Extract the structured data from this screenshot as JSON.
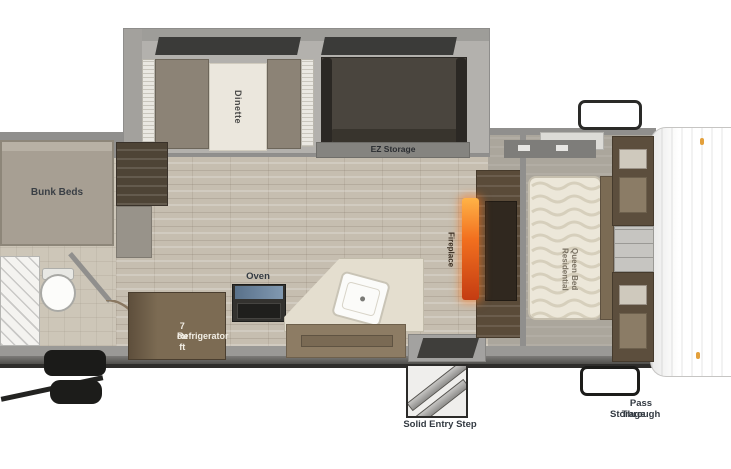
{
  "diagram_type": "rv-travel-trailer-floorplan",
  "labels": {
    "bunk_beds": "Bunk Beds",
    "dinette": "Dinette",
    "ez_storage": "EZ Storage",
    "fireplace": "Fireplace",
    "queen_bed_line1": "Residential",
    "queen_bed_line2": "Queen Bed",
    "oven": "Oven",
    "fridge_line1": "7 cu ft",
    "fridge_line2": "Refrigerator",
    "entry_step": "Solid Entry Step",
    "pass_through_line1": "Pass Through",
    "pass_through_line2": "Storage"
  },
  "colors": {
    "wall": "#908f8d",
    "floor_wood": "#c6beb0",
    "floor_tile": "#cdc6b8",
    "floor_bedroom": "#aba69c",
    "slideout": "#b3b1ad",
    "bench": "#8c8376",
    "table": "#ebe7dd",
    "sofa": "#4a453e",
    "storage_bar": "#858480",
    "bunk": "#a79f93",
    "cabinet_dark": "#4e4436",
    "fridge": "#7c6b53",
    "counter": "#e4decf",
    "kitchen_cabinet": "#8d7c64",
    "mattress": "#ece7d9",
    "wood": "#5c4e3d",
    "fireplace": "#f2701f",
    "frame": "#2e2d2b",
    "tire": "#1b1b19",
    "label_text": "#333a42"
  }
}
